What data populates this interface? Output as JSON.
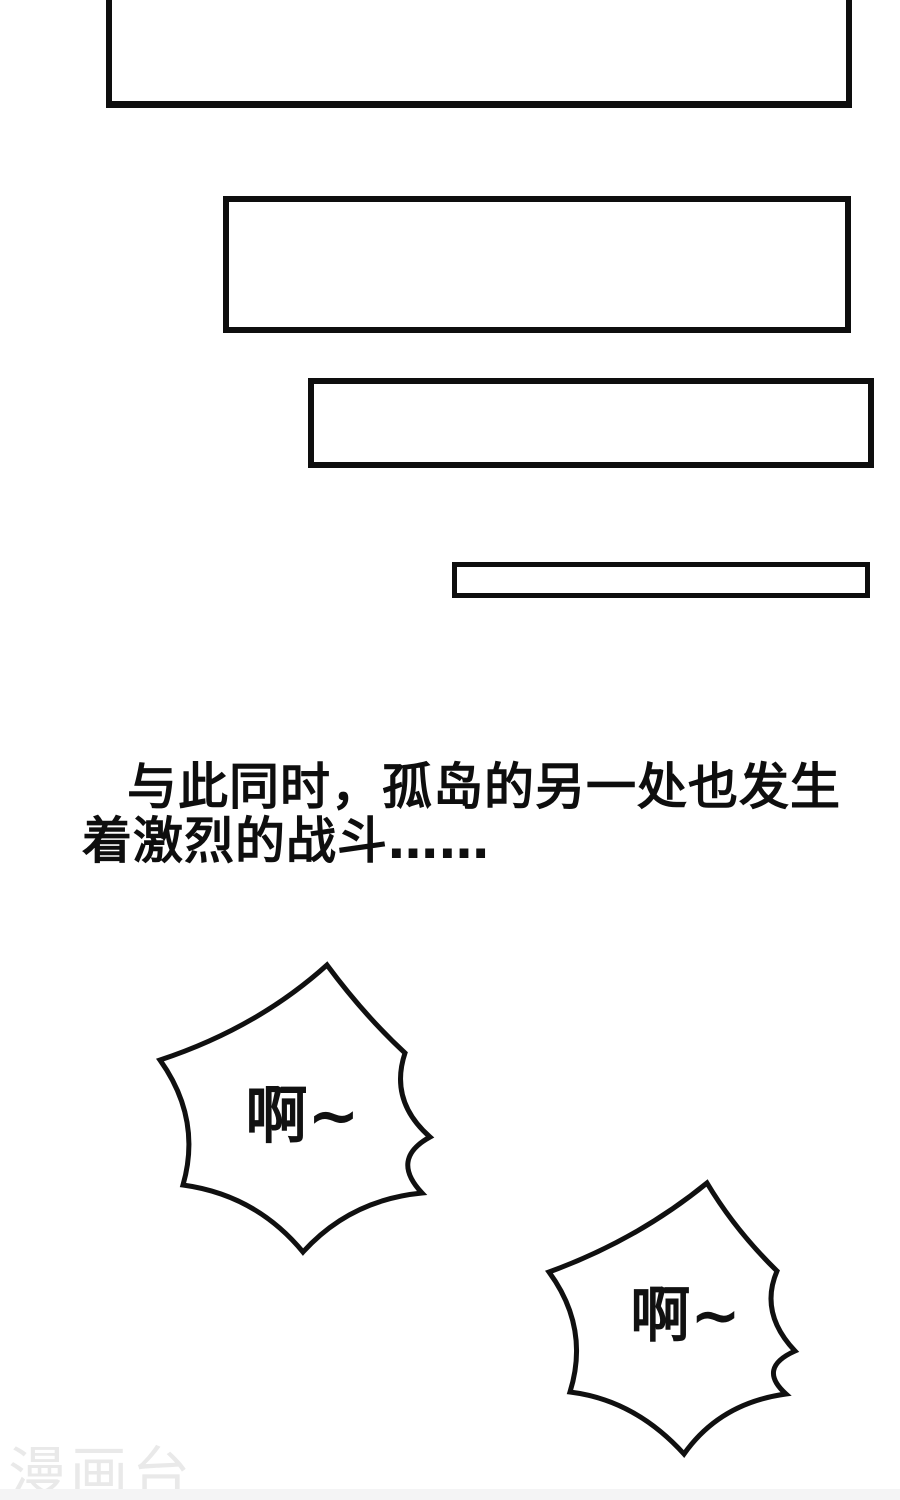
{
  "page": {
    "background_color": "#ffffff",
    "ink_color": "#0e0e0e",
    "kind": "comic-page"
  },
  "narration": {
    "line1": "与此同时，孤岛的另一处也发生",
    "line2": "着激烈的战斗……"
  },
  "bubbles": {
    "scream1": "啊~",
    "scream2": "啊~"
  },
  "watermark": {
    "label": "漫画台",
    "color": "#e9e9e9"
  }
}
